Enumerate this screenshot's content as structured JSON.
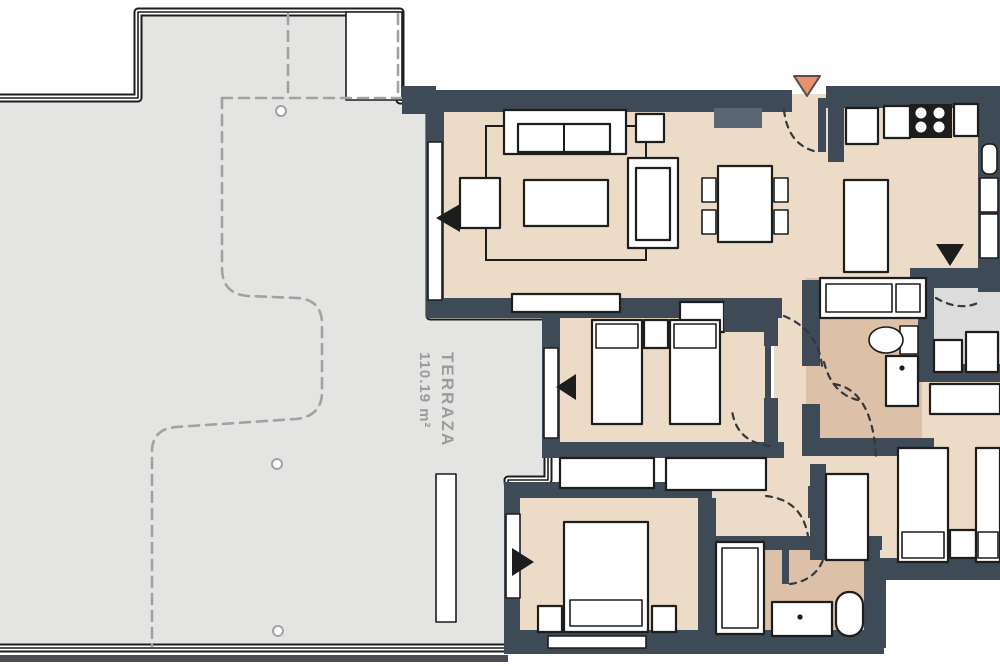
{
  "meta": {
    "description": "Apartment floor plan with large terrace"
  },
  "terrace": {
    "label_line1": "TERRAZA",
    "label_line2": "110.19 m²"
  },
  "colors": {
    "wall": "#3e4a56",
    "floor": "#ecdcc7",
    "bath": "#dcc0a8",
    "terrace": "#e4e4e3",
    "utility": "#dcdcdc",
    "line": "#1d1d1d",
    "dash": "#a2a2a2",
    "label": "#9b9b9b",
    "accent": "#e8916a",
    "accent_stroke": "#55504b",
    "cupboard": "#5a6673",
    "base_band": "#4a4e52"
  }
}
